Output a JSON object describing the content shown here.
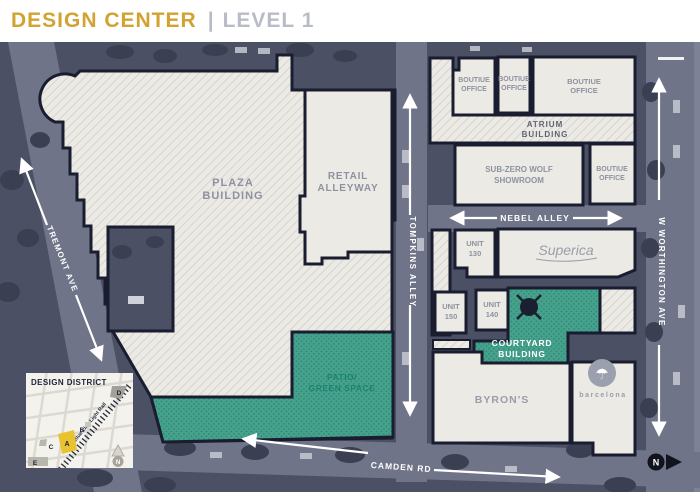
{
  "header": {
    "title": "DESIGN CENTER",
    "divider": "|",
    "subtitle": "LEVEL 1"
  },
  "colors": {
    "accent_gold": "#d2a232",
    "header_gray": "#b8bcc6",
    "teal_green_space": "#47a28d",
    "teal_dot": "#2f8a75",
    "building_fill": "#eceae5",
    "building_outline": "#191d2f",
    "label_gray": "#8e92a0",
    "aerial_base": "#4b5065",
    "street_gray": "#6f7488",
    "street_label_white": "#ffffff",
    "patio_label_teal": "#1d8270",
    "inset_yellow": "#e9c32f",
    "inset_navy": "#202639"
  },
  "map": {
    "buildings": {
      "plaza": {
        "line1": "PLAZA",
        "line2": "BUILDING"
      },
      "retail": {
        "line1": "RETAIL",
        "line2": "ALLEYWAY"
      },
      "boutique": {
        "line1": "BOUTIUE",
        "line2": "OFFICE"
      },
      "atrium": {
        "line1": "ATRIUM",
        "line2": "BUILDING"
      },
      "subzero": {
        "line1": "SUB-ZERO WOLF",
        "line2": "SHOWROOM"
      },
      "unit130": {
        "line1": "UNIT",
        "line2": "130"
      },
      "unit140": {
        "line1": "UNIT",
        "line2": "140"
      },
      "unit150": {
        "line1": "UNIT",
        "line2": "150"
      },
      "superica": {
        "name": "Superica"
      },
      "courtyard": {
        "line1": "COURTYARD",
        "line2": "BUILDING"
      },
      "byrons": {
        "name": "BYRON'S"
      },
      "barcelona": {
        "name": "barcelona"
      },
      "patio": {
        "line1": "PATIO/",
        "line2": "GREEN SPACE"
      }
    },
    "streets": {
      "tremont": "TREMONT AVE",
      "tompkins": "TOMPKINS ALLEY",
      "worthington": "W WORTHINGTON AVE",
      "nebel": "NEBEL ALLEY",
      "camden": "CAMDEN RD"
    },
    "compass": {
      "n": "N"
    },
    "inset": {
      "title": "DESIGN DISTRICT",
      "rail_label": "Blue Line Light Rail",
      "markers": {
        "a": "A",
        "b": "B",
        "c": "C",
        "d": "D",
        "e": "E"
      },
      "north": "N"
    }
  }
}
